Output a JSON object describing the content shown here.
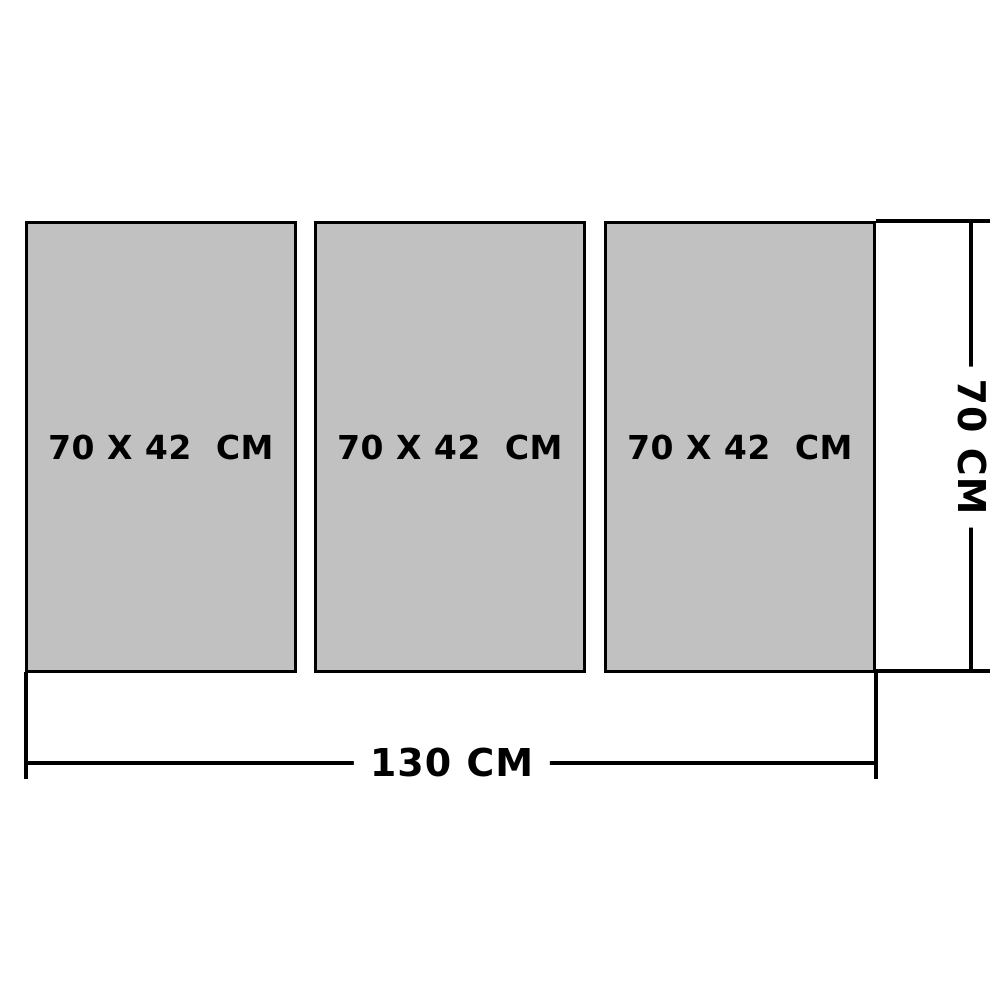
{
  "diagram": {
    "title": "triptych-panel-size-diagram",
    "panels": [
      {
        "label": "70 X 42  СМ"
      },
      {
        "label": "70 X 42  СМ"
      },
      {
        "label": "70 X 42  СМ"
      }
    ],
    "dimensions": {
      "total_width_label": "130 СМ",
      "total_height_label": "70 СМ"
    },
    "colors": {
      "panel_fill": "#c1c1c1",
      "line": "#000000",
      "background": "#ffffff",
      "text": "#000000"
    }
  }
}
